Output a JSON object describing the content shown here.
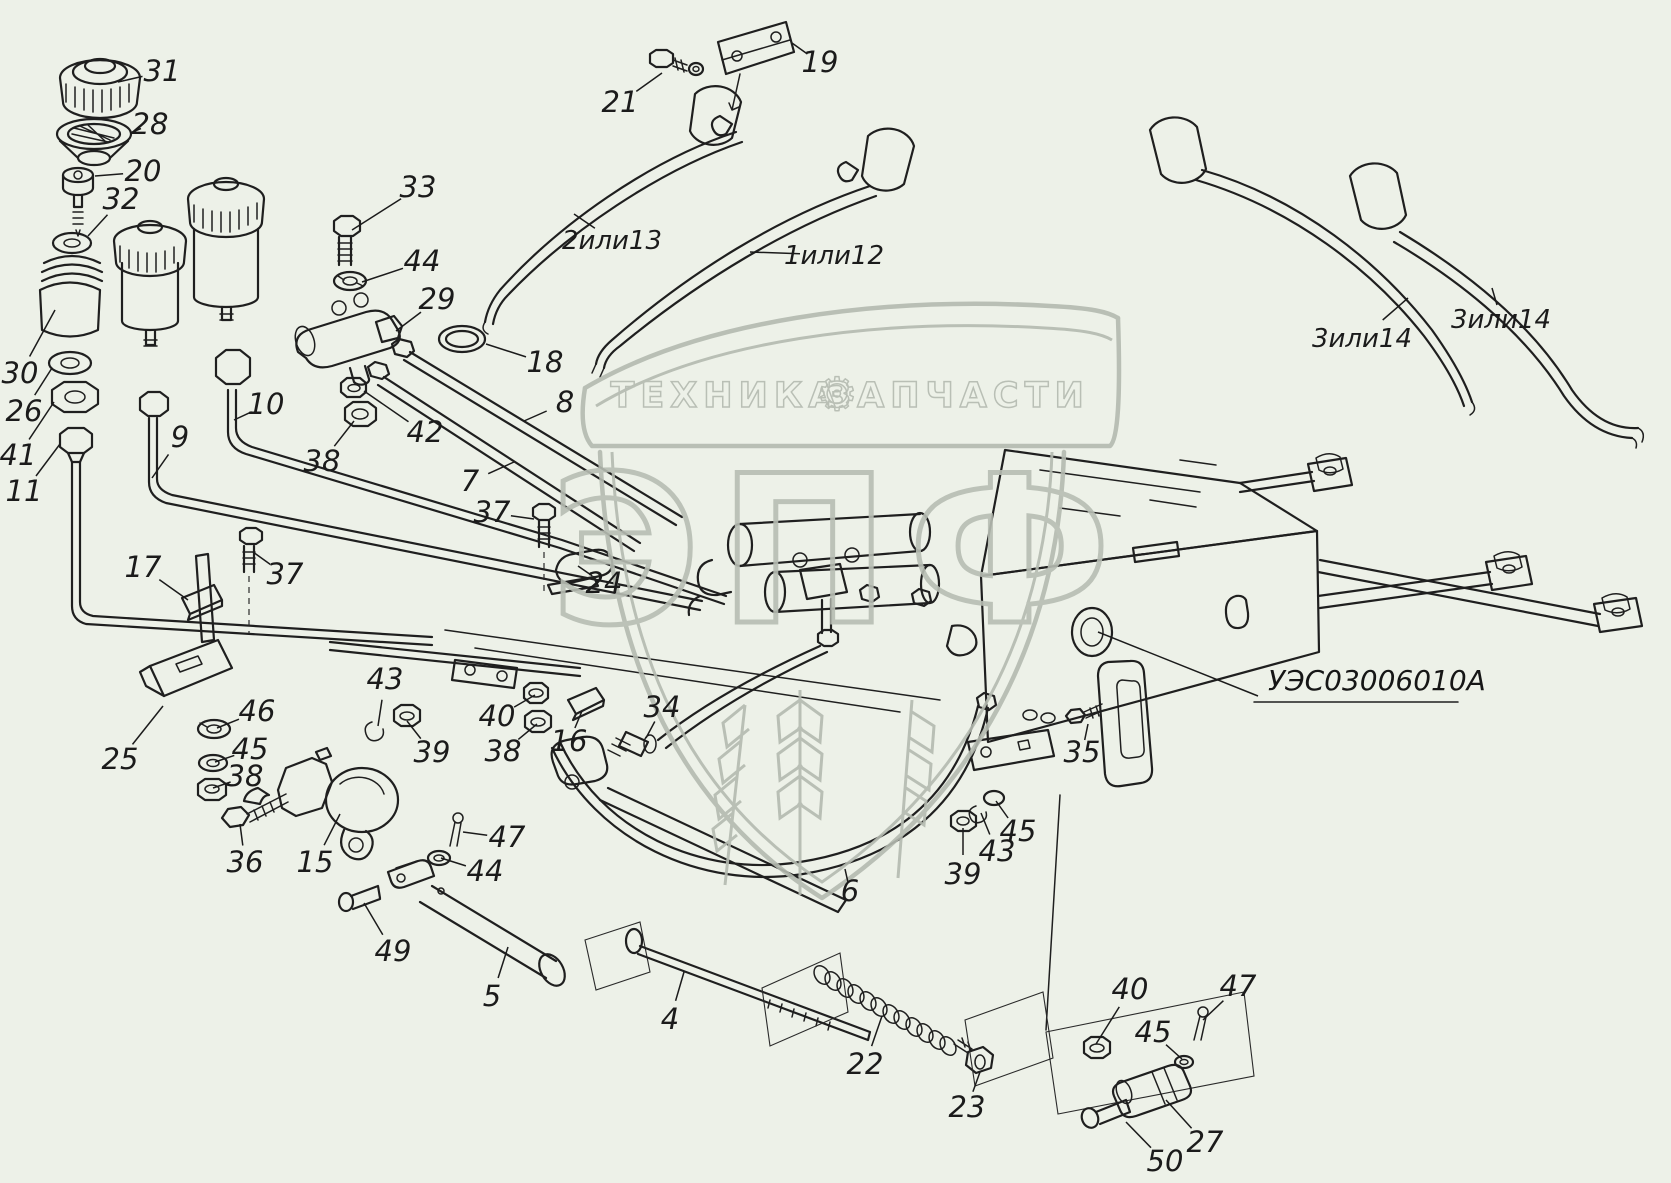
{
  "page": {
    "background": "#edf1e8",
    "ink": "#1f1f1f",
    "watermark_color": "#b4bab0"
  },
  "part_number": "УЭС03006010А",
  "watermark": {
    "banner_left": "ТЕХНИКА",
    "banner_right": "ЗАПЧАСТИ",
    "gear_icon": "⚙",
    "letters": "ЭПФ"
  },
  "callouts": [
    {
      "label": "31",
      "tx": 162,
      "ty": 72,
      "px": 118,
      "py": 82
    },
    {
      "label": "28",
      "tx": 150,
      "ty": 125,
      "px": 130,
      "py": 133
    },
    {
      "label": "20",
      "tx": 143,
      "ty": 172,
      "px": 95,
      "py": 176
    },
    {
      "label": "32",
      "tx": 121,
      "ty": 200,
      "px": 88,
      "py": 236
    },
    {
      "label": "30",
      "tx": 20,
      "ty": 374,
      "px": 55,
      "py": 310
    },
    {
      "label": "26",
      "tx": 24,
      "ty": 412,
      "px": 52,
      "py": 368
    },
    {
      "label": "41",
      "tx": 18,
      "ty": 456,
      "px": 54,
      "py": 402
    },
    {
      "label": "11",
      "tx": 24,
      "ty": 492,
      "px": 60,
      "py": 444
    },
    {
      "label": "9",
      "tx": 180,
      "ty": 438,
      "px": 152,
      "py": 478
    },
    {
      "label": "10",
      "tx": 266,
      "ty": 405,
      "px": 234,
      "py": 420
    },
    {
      "label": "33",
      "tx": 418,
      "ty": 188,
      "px": 352,
      "py": 230
    },
    {
      "label": "44",
      "tx": 422,
      "ty": 262,
      "px": 362,
      "py": 282
    },
    {
      "label": "29",
      "tx": 437,
      "ty": 300,
      "px": 396,
      "py": 331
    },
    {
      "label": "42",
      "tx": 425,
      "ty": 433,
      "px": 364,
      "py": 391
    },
    {
      "label": "38",
      "tx": 322,
      "ty": 462,
      "px": 354,
      "py": 421
    },
    {
      "label": "18",
      "tx": 545,
      "ty": 363,
      "px": 486,
      "py": 344
    },
    {
      "label": "8",
      "tx": 565,
      "ty": 403,
      "px": 524,
      "py": 421
    },
    {
      "label": "7",
      "tx": 470,
      "ty": 482,
      "px": 514,
      "py": 462
    },
    {
      "label": "37",
      "tx": 492,
      "ty": 513,
      "px": 534,
      "py": 519
    },
    {
      "label": "24",
      "tx": 604,
      "ty": 584,
      "px": 578,
      "py": 566
    },
    {
      "label": "17",
      "tx": 143,
      "ty": 568,
      "px": 188,
      "py": 600
    },
    {
      "label": "37",
      "tx": 285,
      "ty": 575,
      "px": 253,
      "py": 552
    },
    {
      "label": "25",
      "tx": 120,
      "ty": 760,
      "px": 163,
      "py": 706
    },
    {
      "label": "46",
      "tx": 257,
      "ty": 712,
      "px": 217,
      "py": 728
    },
    {
      "label": "45",
      "tx": 250,
      "ty": 750,
      "px": 215,
      "py": 762
    },
    {
      "label": "38",
      "tx": 245,
      "ty": 777,
      "px": 213,
      "py": 788
    },
    {
      "label": "36",
      "tx": 245,
      "ty": 863,
      "px": 240,
      "py": 824
    },
    {
      "label": "15",
      "tx": 315,
      "ty": 863,
      "px": 340,
      "py": 814
    },
    {
      "label": "43",
      "tx": 385,
      "ty": 680,
      "px": 378,
      "py": 726
    },
    {
      "label": "39",
      "tx": 432,
      "ty": 753,
      "px": 407,
      "py": 721
    },
    {
      "label": "40",
      "tx": 497,
      "ty": 717,
      "px": 535,
      "py": 695
    },
    {
      "label": "38",
      "tx": 503,
      "ty": 752,
      "px": 537,
      "py": 724
    },
    {
      "label": "16",
      "tx": 569,
      "ty": 742,
      "px": 582,
      "py": 711
    },
    {
      "label": "34",
      "tx": 662,
      "ty": 708,
      "px": 646,
      "py": 738
    },
    {
      "label": "47",
      "tx": 507,
      "ty": 838,
      "px": 463,
      "py": 832
    },
    {
      "label": "44",
      "tx": 485,
      "ty": 872,
      "px": 441,
      "py": 858
    },
    {
      "label": "49",
      "tx": 393,
      "ty": 952,
      "px": 364,
      "py": 903
    },
    {
      "label": "5",
      "tx": 492,
      "ty": 997,
      "px": 508,
      "py": 947
    },
    {
      "label": "4",
      "tx": 670,
      "ty": 1020,
      "px": 684,
      "py": 972
    },
    {
      "label": "22",
      "tx": 865,
      "ty": 1065,
      "px": 882,
      "py": 1016
    },
    {
      "label": "23",
      "tx": 967,
      "ty": 1108,
      "px": 980,
      "py": 1072
    },
    {
      "label": "40",
      "tx": 1130,
      "ty": 990,
      "px": 1096,
      "py": 1044
    },
    {
      "label": "45",
      "tx": 1153,
      "ty": 1033,
      "px": 1182,
      "py": 1059
    },
    {
      "label": "47",
      "tx": 1238,
      "ty": 987,
      "px": 1203,
      "py": 1020
    },
    {
      "label": "27",
      "tx": 1205,
      "ty": 1143,
      "px": 1166,
      "py": 1100
    },
    {
      "label": "50",
      "tx": 1165,
      "ty": 1162,
      "px": 1126,
      "py": 1122
    },
    {
      "label": "6",
      "tx": 850,
      "ty": 892,
      "px": 845,
      "py": 869
    },
    {
      "label": "39",
      "tx": 963,
      "ty": 875,
      "px": 963,
      "py": 828
    },
    {
      "label": "43",
      "tx": 997,
      "ty": 852,
      "px": 981,
      "py": 813
    },
    {
      "label": "45",
      "tx": 1018,
      "ty": 832,
      "px": 996,
      "py": 801
    },
    {
      "label": "35",
      "tx": 1082,
      "ty": 753,
      "px": 1088,
      "py": 724
    },
    {
      "label": "19",
      "tx": 820,
      "ty": 63,
      "px": 792,
      "py": 43
    },
    {
      "label": "21",
      "tx": 620,
      "ty": 103,
      "px": 662,
      "py": 73
    },
    {
      "label": "2или13",
      "tx": 612,
      "ty": 240,
      "px": 574,
      "py": 214
    },
    {
      "label": "1или12",
      "tx": 834,
      "ty": 255,
      "px": 750,
      "py": 252
    },
    {
      "label": "3или14",
      "tx": 1362,
      "ty": 338,
      "px": 1408,
      "py": 298
    },
    {
      "label": "3или14",
      "tx": 1501,
      "ty": 319,
      "px": 1492,
      "py": 288
    }
  ]
}
